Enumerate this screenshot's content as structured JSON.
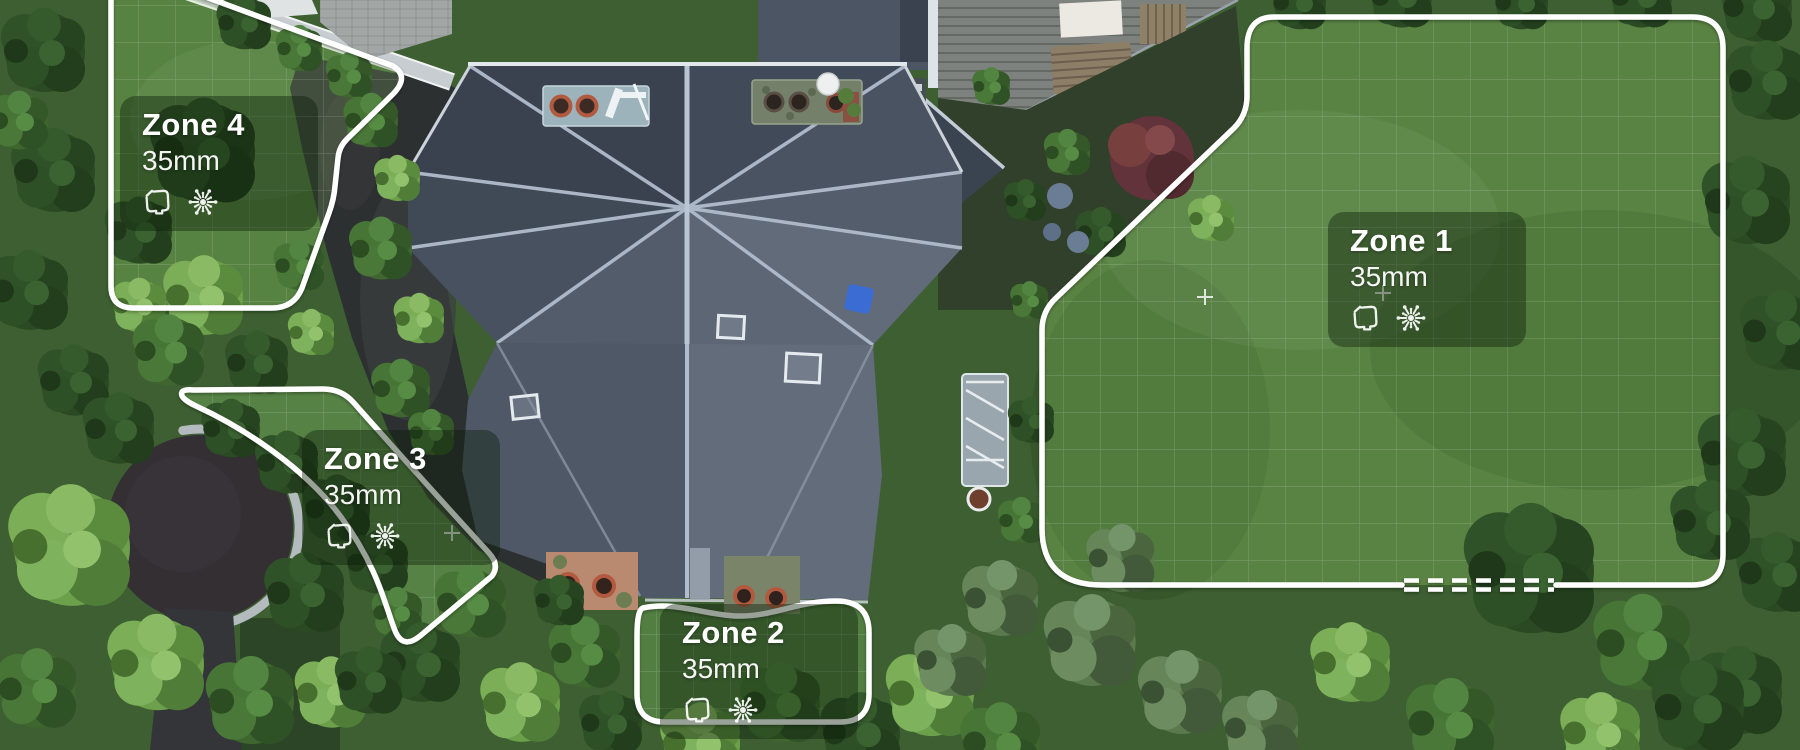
{
  "view": {
    "type": "aerial-map-zones",
    "description": "Aerial lawn map with mowing zones"
  },
  "zones": [
    {
      "name": "Zone 1",
      "cutting_height": "35mm"
    },
    {
      "name": "Zone 2",
      "cutting_height": "35mm"
    },
    {
      "name": "Zone 3",
      "cutting_height": "35mm"
    },
    {
      "name": "Zone 4",
      "cutting_height": "35mm"
    }
  ],
  "icons": {
    "work_area": "work-area-icon",
    "mowing_pattern": "mowing-pattern-icon"
  },
  "colors": {
    "zone_boundary": "#ffffff",
    "zone_grid_line": "rgba(255,255,255,0.16)",
    "zone_tint": "rgba(170,220,120,0.18)",
    "card_background": "rgba(12,30,10,0.42)",
    "card_text": "#ffffff"
  },
  "markers": {
    "zone1_gate_line_style": "dashed"
  }
}
